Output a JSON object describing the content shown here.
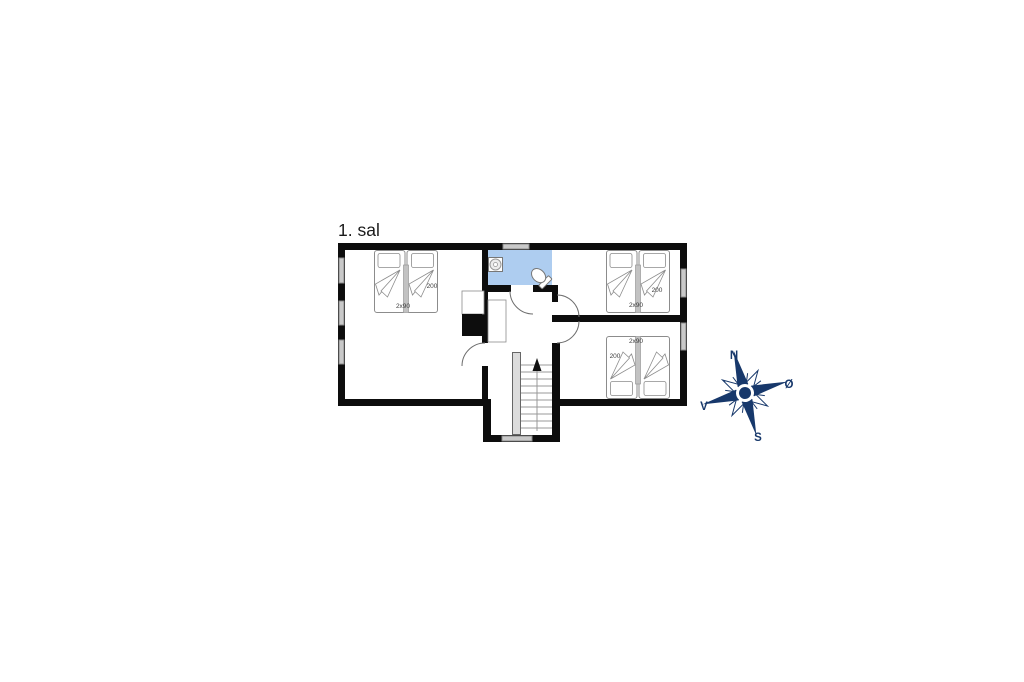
{
  "page": {
    "title": "1. sal"
  },
  "floor_plan": {
    "floor_name": "1. sal",
    "rooms": {
      "bedroom_left": {
        "bed_length": "200",
        "bed_width": "2x90"
      },
      "bedroom_top_right": {
        "bed_length": "200",
        "bed_width": "2x90"
      },
      "bedroom_bottom_right": {
        "bed_length": "200",
        "bed_width": "2x90"
      }
    },
    "features": [
      "bathroom",
      "staircase-up",
      "chimney",
      "three-double-beds"
    ]
  },
  "compass": {
    "north": "N",
    "east": "Ø",
    "south": "S",
    "west": "V"
  },
  "colors": {
    "wall": "#0d0d0d",
    "bathroom_floor": "#aecdf0",
    "window": "#c9c9c9",
    "compass_navy": "#17386b"
  }
}
